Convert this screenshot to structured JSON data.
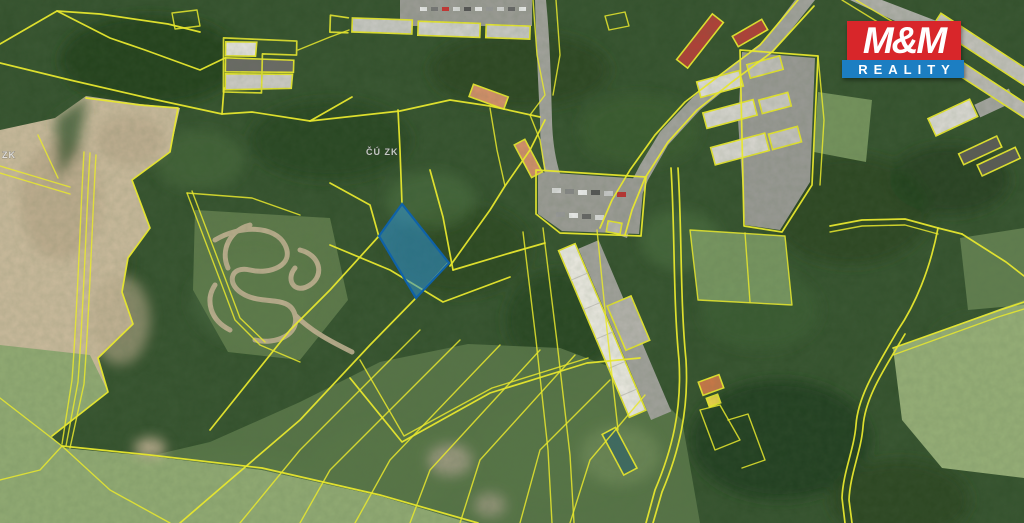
{
  "map": {
    "description": "aerial cadastral map with parcel boundaries",
    "watermark_center": "ČÚ ZK",
    "watermark_left": "ZK",
    "parcel_line_color": "#e7e72e",
    "highlighted_parcel": {
      "fill": "#2f93d4",
      "stroke": "#0f62a8"
    }
  },
  "logo": {
    "line1": "M&M",
    "line2": "REALITY",
    "red": "#d8262b",
    "blue": "#1b7ec2",
    "text_color": "#ffffff"
  }
}
